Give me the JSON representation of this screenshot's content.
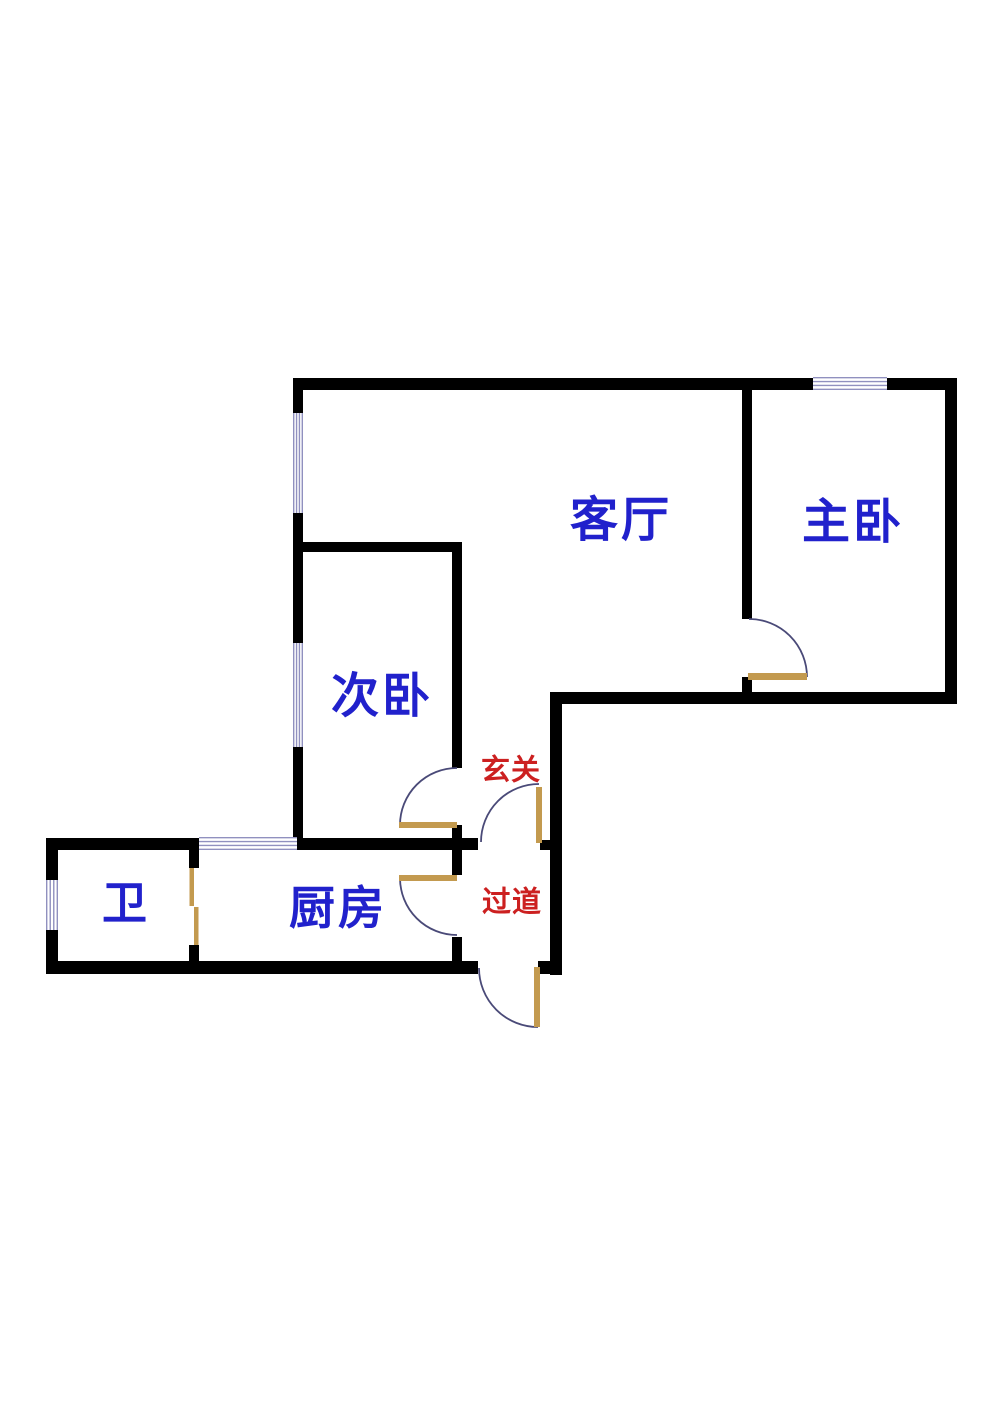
{
  "canvas": {
    "width": 1000,
    "height": 1413,
    "background": "#ffffff"
  },
  "colors": {
    "wall": "#000000",
    "door_leaf": "#c39a4f",
    "door_arc": "#4a4a78",
    "window_line": "#9090bf",
    "window_fill": "#ffffff",
    "room_label": "#2121cc",
    "zone_label": "#cc2020"
  },
  "rooms": [
    {
      "id": "living-room",
      "label": "客厅",
      "x": 621,
      "y": 521,
      "font_size": 48,
      "type": "room"
    },
    {
      "id": "master-bedroom",
      "label": "主卧",
      "x": 853,
      "y": 523,
      "font_size": 48,
      "type": "room"
    },
    {
      "id": "second-bedroom",
      "label": "次卧",
      "x": 382,
      "y": 697,
      "font_size": 48,
      "type": "room"
    },
    {
      "id": "kitchen",
      "label": "厨房",
      "x": 338,
      "y": 909,
      "font_size": 46,
      "type": "room"
    },
    {
      "id": "bathroom",
      "label": "卫",
      "x": 126,
      "y": 904,
      "font_size": 45,
      "type": "room"
    },
    {
      "id": "entry-foyer",
      "label": "玄关",
      "x": 511,
      "y": 771,
      "font_size": 29,
      "type": "zone"
    },
    {
      "id": "hallway",
      "label": "过道",
      "x": 512,
      "y": 903,
      "font_size": 29,
      "type": "zone"
    }
  ],
  "walls": [
    {
      "id": "top-left",
      "x": 293,
      "y": 378,
      "w": 520,
      "h": 12
    },
    {
      "id": "top-right",
      "x": 887,
      "y": 378,
      "w": 70,
      "h": 12
    },
    {
      "id": "right-outer",
      "x": 945,
      "y": 378,
      "w": 12,
      "h": 326
    },
    {
      "id": "master-divider-upper",
      "x": 742,
      "y": 378,
      "w": 10,
      "h": 241
    },
    {
      "id": "master-divider-stub",
      "x": 742,
      "y": 677,
      "w": 10,
      "h": 27
    },
    {
      "id": "south-right-section",
      "x": 550,
      "y": 692,
      "w": 407,
      "h": 12
    },
    {
      "id": "corridor-right",
      "x": 550,
      "y": 692,
      "w": 12,
      "h": 283
    },
    {
      "id": "left-upper",
      "x": 293,
      "y": 378,
      "w": 10,
      "h": 35
    },
    {
      "id": "left-middle",
      "x": 293,
      "y": 513,
      "w": 10,
      "h": 130
    },
    {
      "id": "left-lower",
      "x": 293,
      "y": 747,
      "w": 10,
      "h": 103
    },
    {
      "id": "bedroom2-top",
      "x": 293,
      "y": 542,
      "w": 169,
      "h": 10
    },
    {
      "id": "corridor-left-upper",
      "x": 452,
      "y": 542,
      "w": 10,
      "h": 226
    },
    {
      "id": "corridor-left-mid",
      "x": 452,
      "y": 825,
      "w": 10,
      "h": 50
    },
    {
      "id": "corridor-left-lower",
      "x": 452,
      "y": 937,
      "w": 10,
      "h": 37
    },
    {
      "id": "wc-top",
      "x": 46,
      "y": 838,
      "w": 153,
      "h": 12
    },
    {
      "id": "kitchen-top",
      "x": 297,
      "y": 838,
      "w": 181,
      "h": 12
    },
    {
      "id": "foyer-divider-stub",
      "x": 540,
      "y": 840,
      "w": 22,
      "h": 10
    },
    {
      "id": "wc-left-upper",
      "x": 46,
      "y": 838,
      "w": 12,
      "h": 42
    },
    {
      "id": "wc-left-lower",
      "x": 46,
      "y": 930,
      "w": 12,
      "h": 44
    },
    {
      "id": "wc-divider-upper",
      "x": 189,
      "y": 838,
      "w": 10,
      "h": 30
    },
    {
      "id": "wc-divider-lower",
      "x": 189,
      "y": 945,
      "w": 10,
      "h": 29
    },
    {
      "id": "bottom-main",
      "x": 46,
      "y": 961,
      "w": 432,
      "h": 13
    },
    {
      "id": "bottom-stub",
      "x": 538,
      "y": 961,
      "w": 24,
      "h": 13
    }
  ],
  "windows": [
    {
      "id": "living-left",
      "x": 293,
      "y": 413,
      "w": 10,
      "h": 100,
      "orient": "v"
    },
    {
      "id": "bedroom2-left",
      "x": 293,
      "y": 643,
      "w": 10,
      "h": 104,
      "orient": "v"
    },
    {
      "id": "master-top",
      "x": 813,
      "y": 377,
      "w": 74,
      "h": 13,
      "orient": "h"
    },
    {
      "id": "wc-left",
      "x": 46,
      "y": 880,
      "w": 12,
      "h": 50,
      "orient": "v"
    },
    {
      "id": "kitchen-top",
      "x": 199,
      "y": 837,
      "w": 98,
      "h": 13,
      "orient": "h"
    }
  ],
  "doors": {
    "leaves": [
      {
        "id": "master-bedroom",
        "x": 748,
        "y": 673,
        "w": 59,
        "h": 7
      },
      {
        "id": "second-bedroom",
        "x": 399,
        "y": 822,
        "w": 58,
        "h": 6
      },
      {
        "id": "kitchen",
        "x": 399,
        "y": 875,
        "w": 58,
        "h": 6
      },
      {
        "id": "entry-inner",
        "x": 536,
        "y": 787,
        "w": 6,
        "h": 56
      },
      {
        "id": "entry-outer",
        "x": 534,
        "y": 967,
        "w": 6,
        "h": 60
      },
      {
        "id": "wc-slider-a",
        "x": 189.5,
        "y": 868,
        "w": 4.5,
        "h": 38
      },
      {
        "id": "wc-slider-b",
        "x": 194,
        "y": 907,
        "w": 4.5,
        "h": 38
      }
    ],
    "arcs": [
      {
        "id": "master-bedroom",
        "path": "M 749 619 A 58 58 0 0 1 807 677"
      },
      {
        "id": "second-bedroom",
        "path": "M 457 768 A 57 57 0 0 0 400 825"
      },
      {
        "id": "kitchen",
        "path": "M 400 878 A 57 57 0 0 0 457 935"
      },
      {
        "id": "entry-inner",
        "path": "M 481 842 A 58 58 0 0 1 539 784"
      },
      {
        "id": "entry-outer",
        "path": "M 479 968 A 59 59 0 0 0 538 1027"
      }
    ]
  }
}
